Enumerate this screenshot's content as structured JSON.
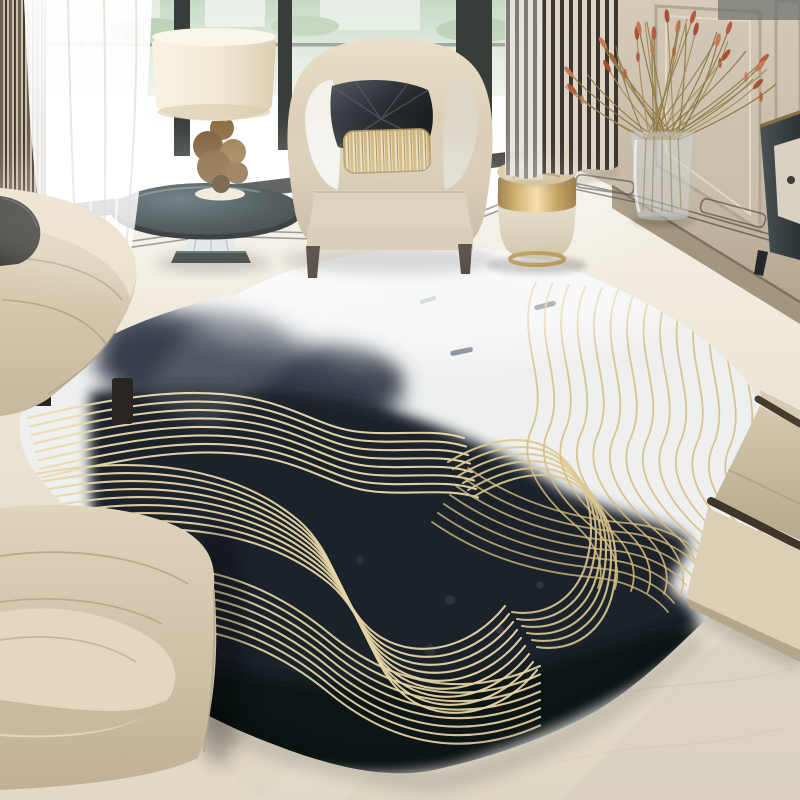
{
  "scene": {
    "description": "Modern living-room corner: large round abstract rug (black ink wash with gold wavy line art on white), beige curved sofas, barrel armchair with black satin and gold striped pillows, smoked-glass side table with cream drum lamp, gold-banded drum stool with glass bottle, tall glass vase of red dried reeds, charcoal cabinet, panel-molded wall, floor-to-ceiling window with striped and sheer drapes, polished marble floor with dark inlay border.",
    "width": 800,
    "height": 800
  },
  "palette": {
    "floor_light": "#faf8f2",
    "floor_mid": "#e9e2d3",
    "floor_dark": "#ddd4c2",
    "wall": "#cdc1af",
    "wall_molding": "#b3a591",
    "baseboard": "#a3967f",
    "window_glass_top": "#c9dcc9",
    "window_glass": "#f3f6f1",
    "window_frame": "#393d39",
    "curtain_stripe_dark": "#35302a",
    "curtain_stripe_light": "#ddd5c6",
    "curtain_left_dark": "#6e604e",
    "sheer_white": "#ffffff",
    "sofa_beige": "#d5c7ad",
    "sofa_shadow": "#b5a387",
    "chair_beige": "#d8cab0",
    "pillow_black": "#1f2226",
    "pillow_gold": "#cdb06e",
    "rug_white": "#eef0ef",
    "rug_ink": "#1c212b",
    "rug_ink_soft": "#434b59",
    "rug_ink_deep": "#0f1218",
    "rug_gold_on_dark": "#ead9ab",
    "rug_gold_on_white": "#d5bc7f",
    "stool_gold": "#caa554",
    "stool_body": "#e2d7bf",
    "lamp_shade": "#f2ead9",
    "lamp_base_wood": "#83643c",
    "table_glass_dark": "#22302f",
    "flower_rust": "#b5563a",
    "flower_stem": "#8f7b49",
    "cabinet_dark": "#353c3f",
    "border_inlay": "#45443f",
    "wood_rail": "#473c2f"
  },
  "objects": {
    "rug_label": "round ink-and-gold art rug",
    "sofa_left_label": "curved beige fabric sofa",
    "lounge_label": "curved lounge sofa",
    "armchair_label": "beige barrel armchair",
    "pillow_black_label": "black satin geometric pillow",
    "pillow_gold_label": "gold striped lumbar pillow",
    "side_table_label": "smoked-glass side table with crystal base",
    "lamp_label": "drum-shade table lamp",
    "stool_label": "cream drum stool with gold band",
    "bottle_label": "glass bottle",
    "vase_label": "tall glass vase",
    "flowers_label": "red dried reed bouquet",
    "cabinet_label": "charcoal side cabinet",
    "armchair_right_label": "beige armchair with dark wood rails",
    "window_label": "floor-to-ceiling window",
    "curtain_right_label": "striped drape",
    "curtain_left_label": "striped drape",
    "sheer_label": "white sheer curtain",
    "wall_label": "panel-molding wall",
    "floor_label": "marble floor with inlay border"
  }
}
